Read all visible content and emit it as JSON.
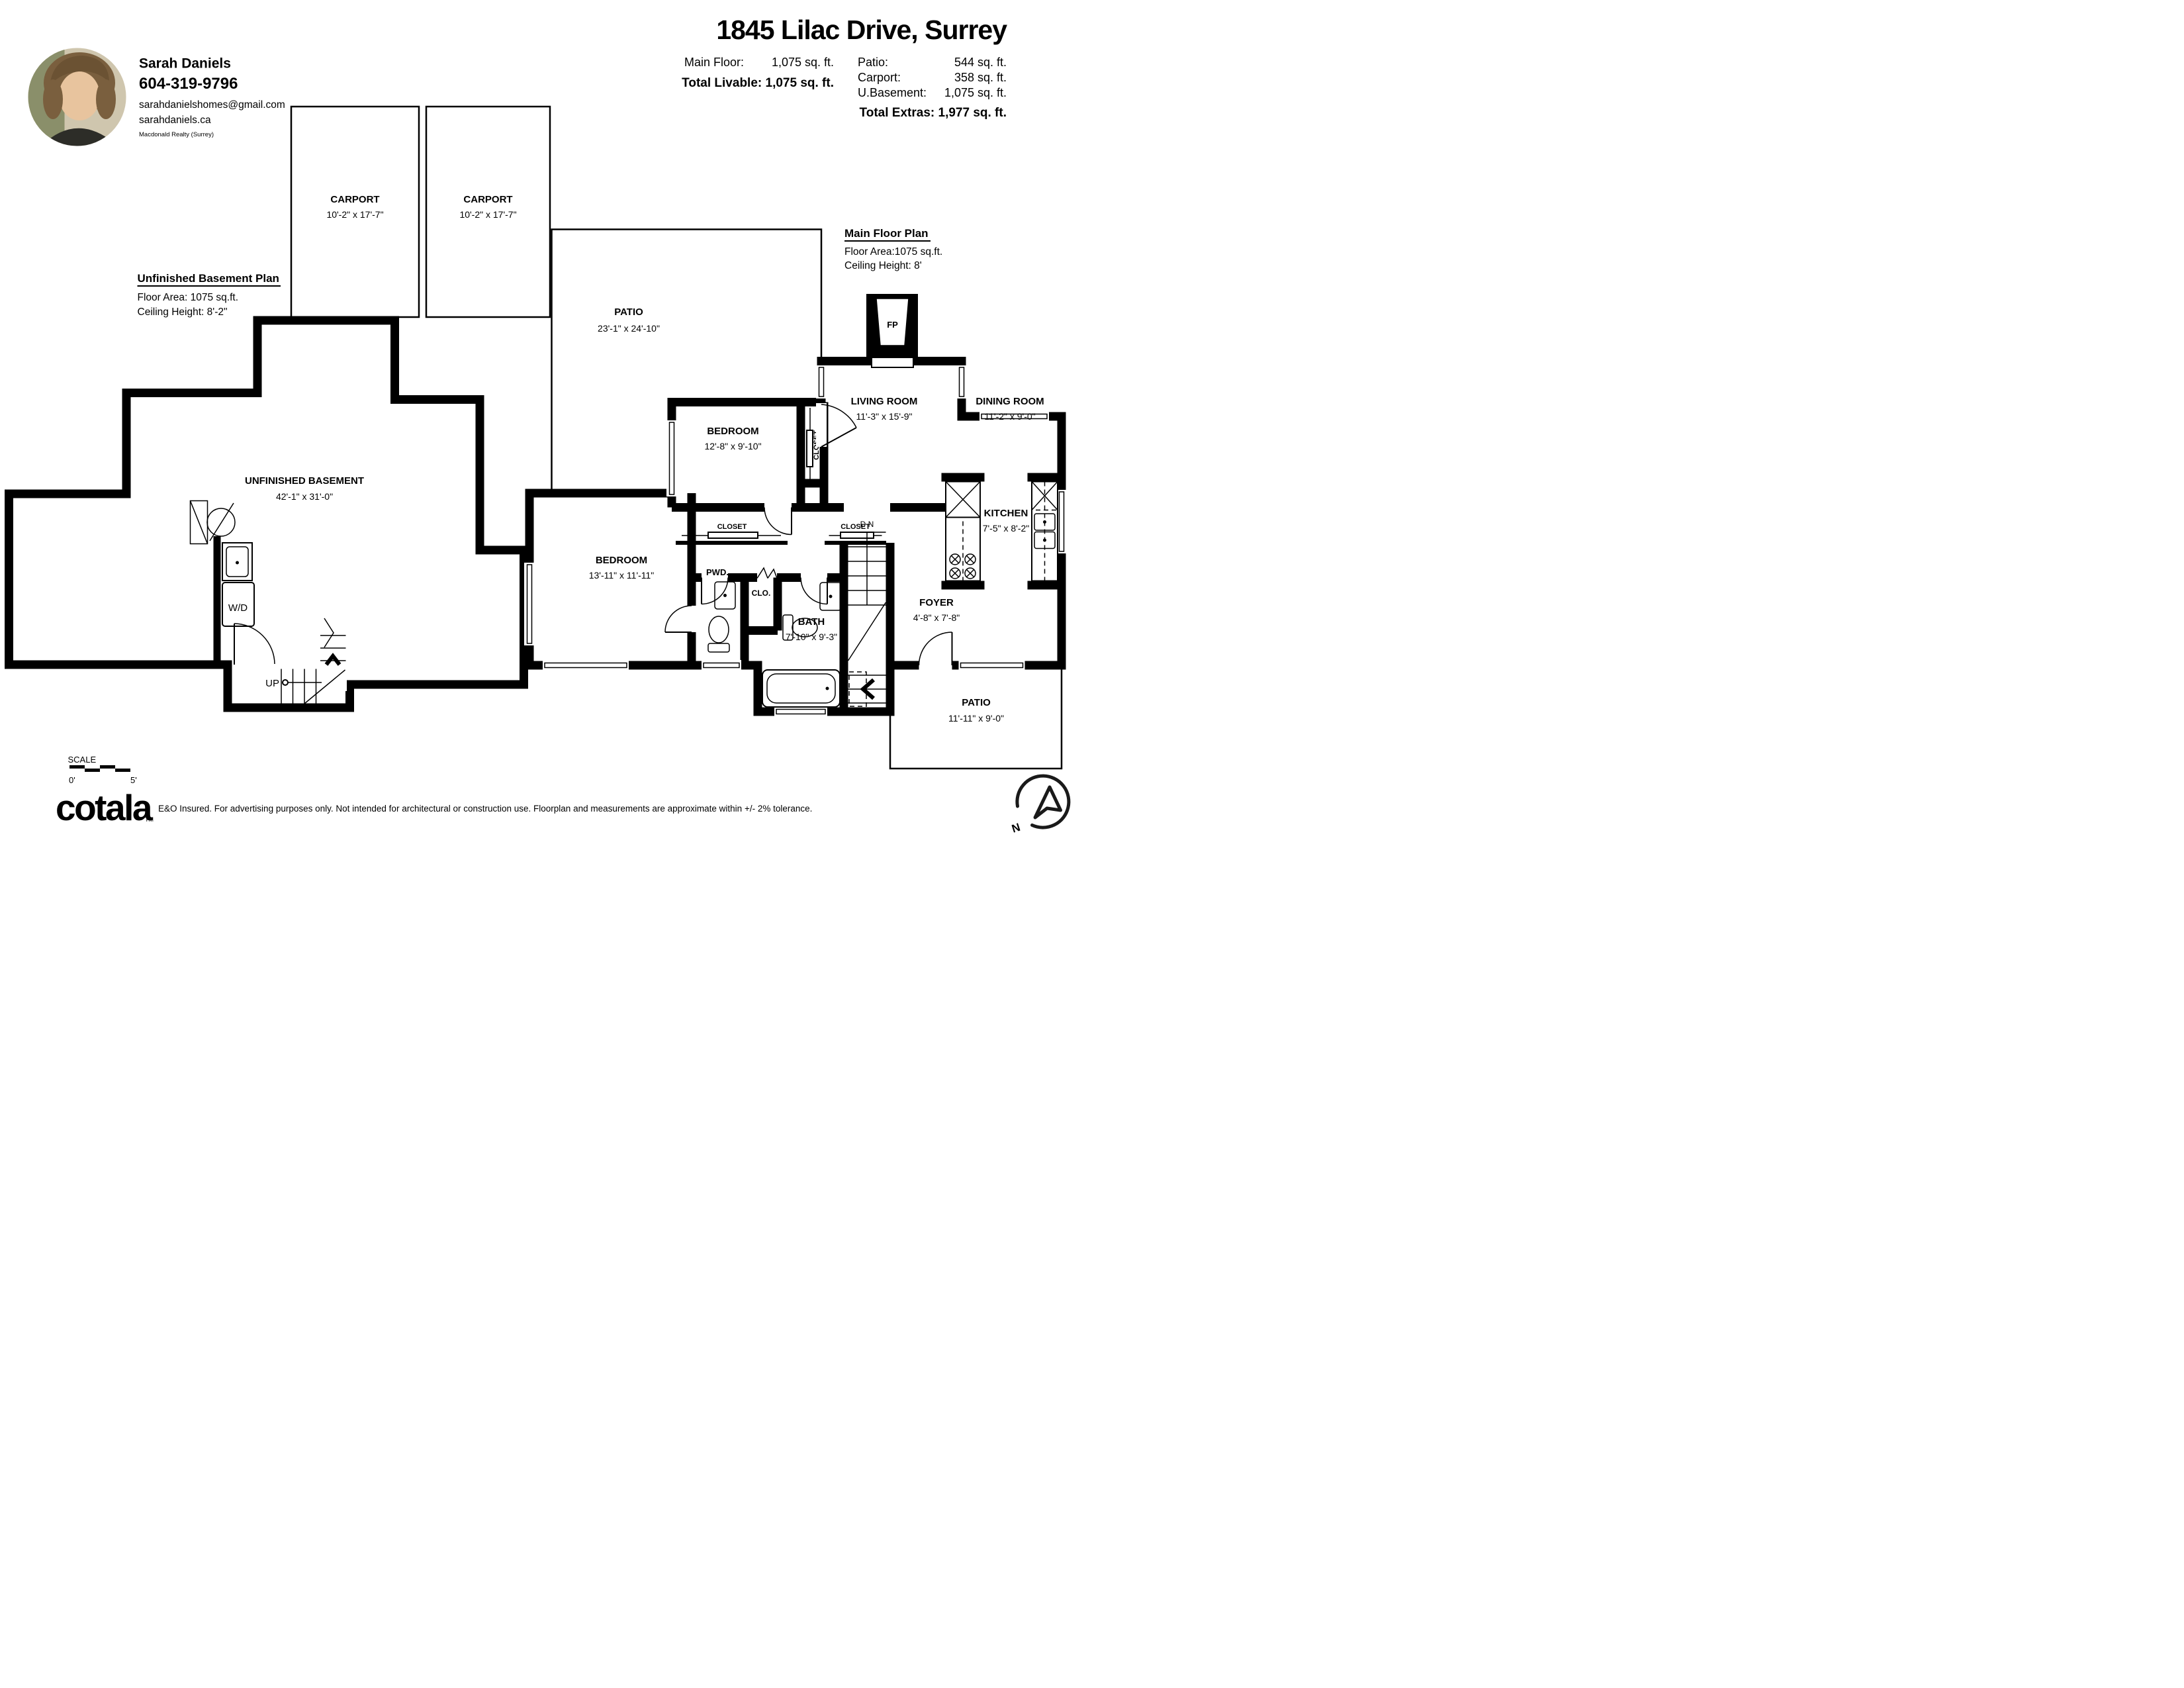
{
  "agent": {
    "name": "Sarah Daniels",
    "phone": "604-319-9796",
    "email": "sarahdanielshomes@gmail.com",
    "website": "sarahdaniels.ca",
    "brokerage": "Macdonald Realty (Surrey)"
  },
  "header": {
    "title": "1845 Lilac Drive, Surrey",
    "main_floor_label": "Main Floor:",
    "main_floor_value": "1,075 sq. ft.",
    "total_livable": "Total Livable: 1,075 sq. ft.",
    "patio_label": "Patio:",
    "patio_value": "544 sq. ft.",
    "carport_label": "Carport:",
    "carport_value": "358 sq. ft.",
    "ubasement_label": "U.Basement:",
    "ubasement_value": "1,075 sq. ft.",
    "total_extras": "Total Extras:  1,977 sq. ft."
  },
  "carport": {
    "name": "CARPORT",
    "dims": "10'-2\" x 17'-7\""
  },
  "basement": {
    "heading": "Unfinished Basement Plan",
    "floor_area": "Floor Area: 1075 sq.ft.",
    "ceiling": "Ceiling Height: 8'-2\"",
    "room": "UNFINISHED BASEMENT",
    "dims": "42'-1\" x 31'-0\"",
    "wd": "W/D",
    "up": "UP"
  },
  "main": {
    "heading": "Main Floor Plan",
    "floor_area": "Floor Area:1075 sq.ft.",
    "ceiling": "Ceiling Height: 8'",
    "patio": {
      "name": "PATIO",
      "dims": "23'-1\" x 24'-10\""
    },
    "bedroom1": {
      "name": "BEDROOM",
      "dims": "12'-8\" x 9'-10\""
    },
    "living": {
      "name": "LIVING ROOM",
      "dims": "11'-3\" x 15'-9\""
    },
    "dining": {
      "name": "DINING ROOM",
      "dims": "11'-2\" x 9'-0\""
    },
    "kitchen": {
      "name": "KITCHEN",
      "dims": "7'-5\" x 8'-2\""
    },
    "bedroom2": {
      "name": "BEDROOM",
      "dims": "13'-11\" x 11'-11\""
    },
    "pwd": {
      "name": "PWD."
    },
    "clo": {
      "name": "CLO."
    },
    "bath": {
      "name": "BATH",
      "dims": "7'-10\" x 9'-3\""
    },
    "foyer": {
      "name": "FOYER",
      "dims": "4'-8\" x 7'-8\""
    },
    "patio2": {
      "name": "PATIO",
      "dims": "11'-11\" x 9'-0\""
    },
    "closet": "CLOSET",
    "fp": "FP",
    "dn": "D N"
  },
  "scale": {
    "label": "SCALE",
    "start": "0'",
    "end": "5'"
  },
  "compass": {
    "n": "N"
  },
  "footer": {
    "brand": "cotala",
    "tm": "TM",
    "disclaimer": "E&O Insured. For advertising purposes only. Not intended for architectural or construction use. Floorplan and measurements are approximate within +/- 2% tolerance."
  }
}
